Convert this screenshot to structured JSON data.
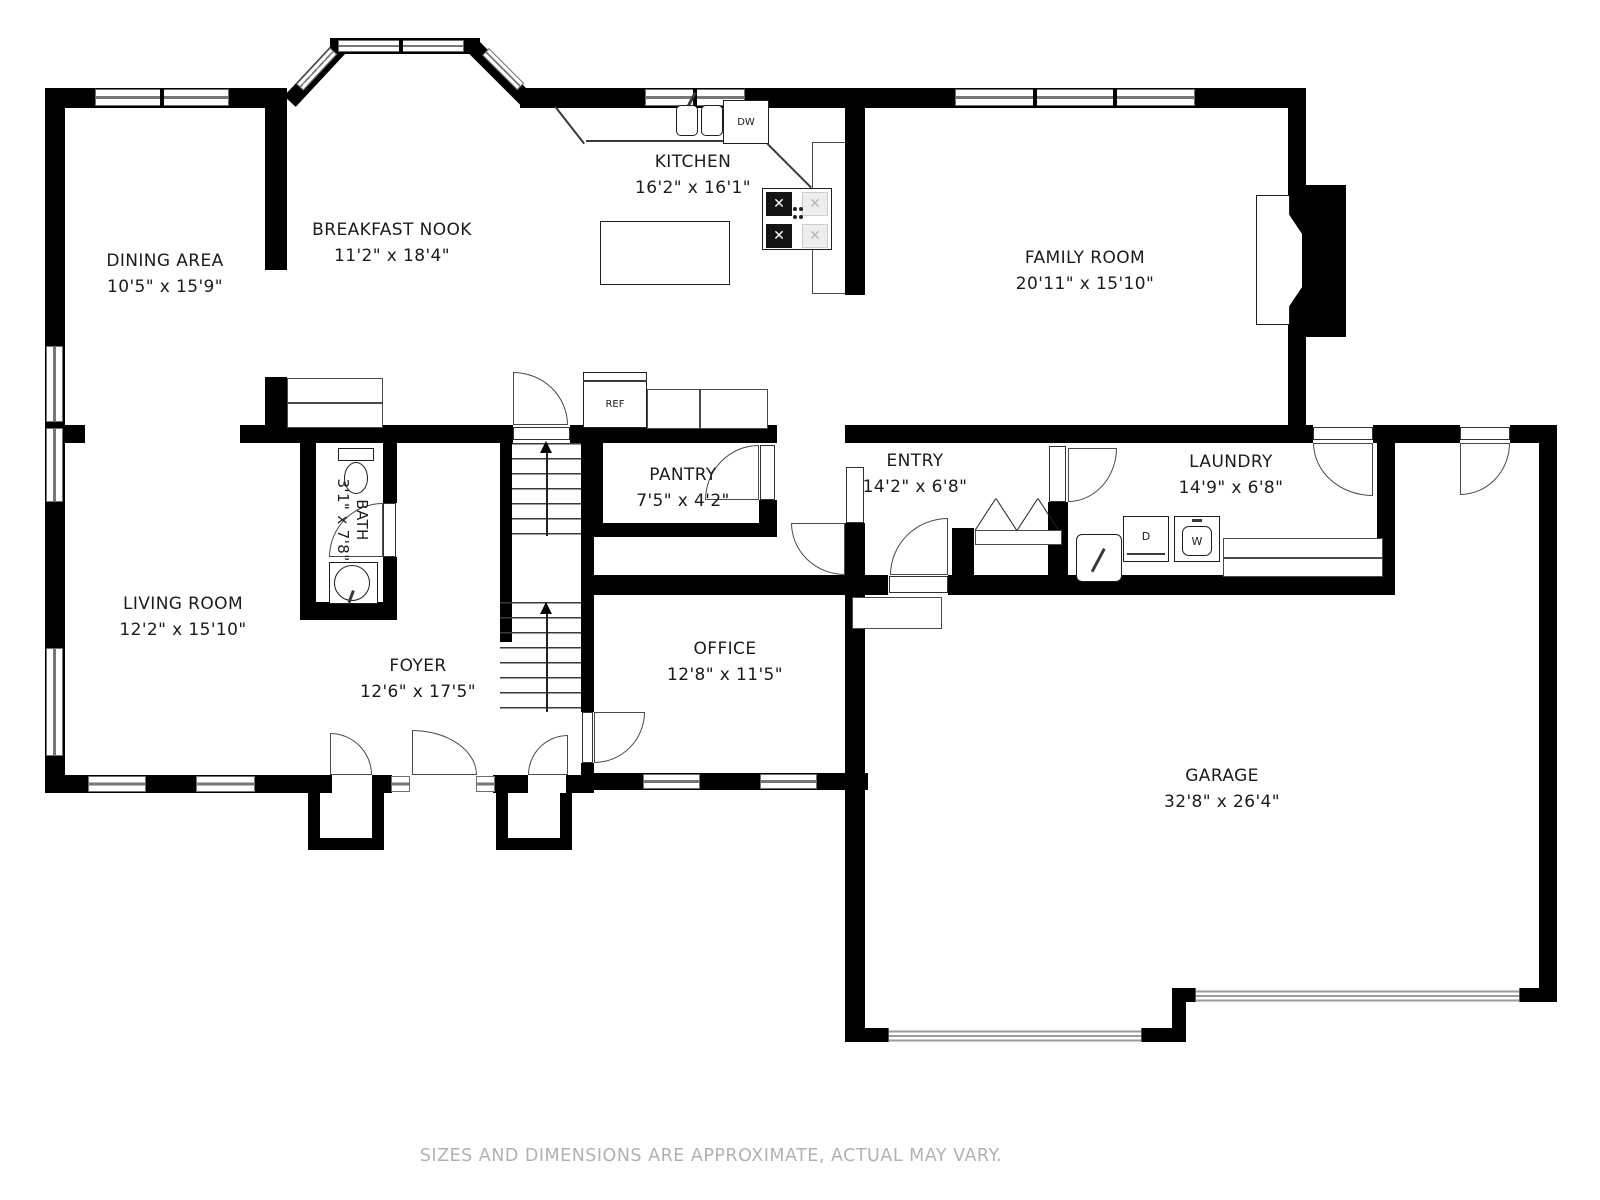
{
  "footer": "SIZES AND DIMENSIONS ARE APPROXIMATE, ACTUAL MAY VARY.",
  "rooms": [
    {
      "name": "DINING AREA",
      "dims": "10'5\" x 15'9\""
    },
    {
      "name": "BREAKFAST NOOK",
      "dims": "11'2\" x 18'4\""
    },
    {
      "name": "KITCHEN",
      "dims": "16'2\" x 16'1\""
    },
    {
      "name": "FAMILY ROOM",
      "dims": "20'11\" x 15'10\""
    },
    {
      "name": "LIVING ROOM",
      "dims": "12'2\" x 15'10\""
    },
    {
      "name": "FOYER",
      "dims": "12'6\" x 17'5\""
    },
    {
      "name": "PANTRY",
      "dims": "7'5\" x 4'2\""
    },
    {
      "name": "OFFICE",
      "dims": "12'8\" x 11'5\""
    },
    {
      "name": "ENTRY",
      "dims": "14'2\" x 6'8\""
    },
    {
      "name": "LAUNDRY",
      "dims": "14'9\" x 6'8\""
    },
    {
      "name": "GARAGE",
      "dims": "32'8\" x 26'4\""
    },
    {
      "name": "BATH",
      "dims": "3'1\" x 7'8\""
    }
  ],
  "fixtures": {
    "refrigerator": "REF",
    "dishwasher": "DW",
    "dryer": "D",
    "washer": "W"
  }
}
